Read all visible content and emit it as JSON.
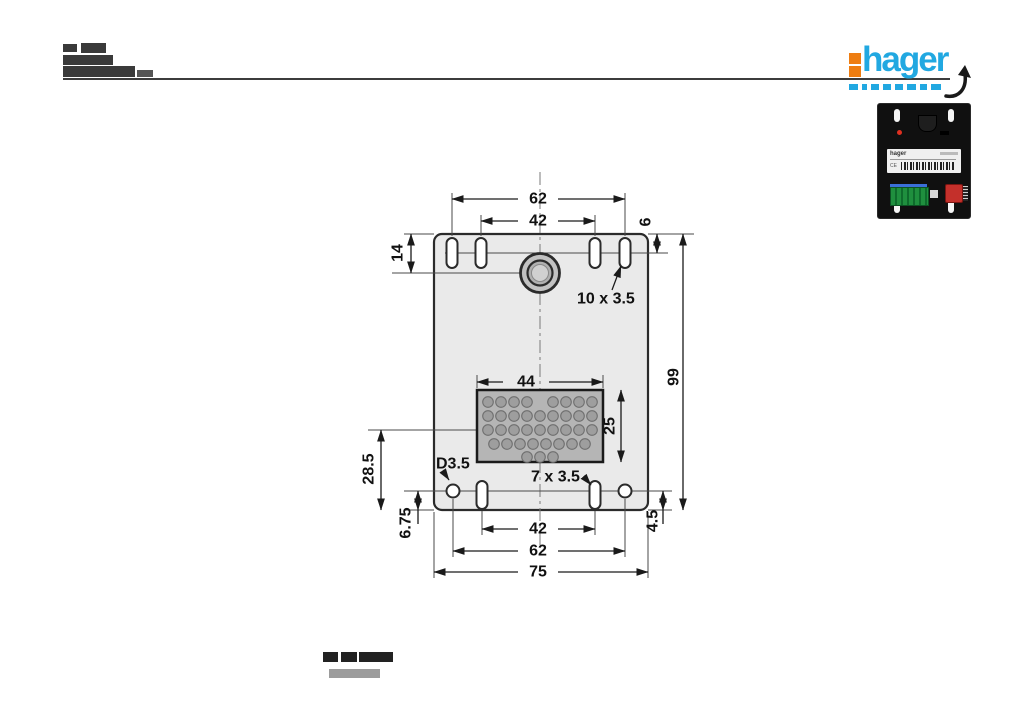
{
  "header": {
    "logo_text": "hager",
    "brand_colors": {
      "blue": "#21a8e1",
      "orange": "#ee7d11"
    }
  },
  "product_photo": {
    "label_brand": "hager"
  },
  "drawing": {
    "dims": {
      "top_outer": "62",
      "top_inner": "42",
      "left_top": "14",
      "right_top": "6",
      "top_slots_label": "10 x 3.5",
      "overall_height": "99",
      "block_width": "44",
      "block_height": "25",
      "left_mid": "28.5",
      "hole_label": "D3.5",
      "bottom_slots_label": "7 x 3.5",
      "left_bottom": "6.75",
      "right_bottom": "4.5",
      "bottom_inner": "42",
      "bottom_outer": "62",
      "overall_width": "75"
    }
  }
}
